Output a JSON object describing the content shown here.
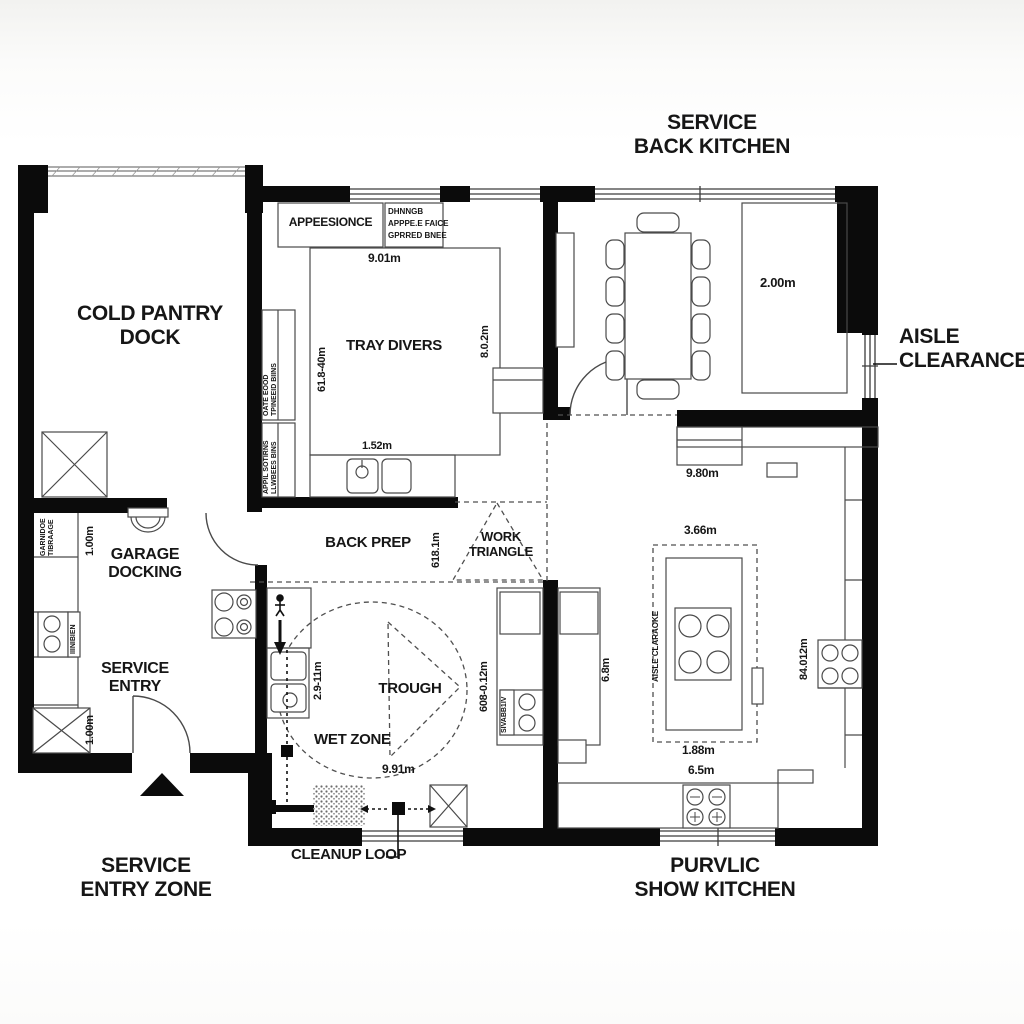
{
  "titles": {
    "back_kitchen_1": "SERVICE",
    "back_kitchen_2": "BACK KITCHEN",
    "show_kitchen_1": "PURVLIC",
    "show_kitchen_2": "SHOW KITCHEN",
    "entry_zone_1": "SERVICE",
    "entry_zone_2": "ENTRY ZONE",
    "aisle_1": "AISLE",
    "aisle_2": "CLEARANCE",
    "cleanup_loop": "CLEANUP LOOP"
  },
  "rooms": {
    "cold_pantry_1": "COLD PANTRY",
    "cold_pantry_2": "DOCK",
    "garage_1": "GARAGE",
    "garage_2": "DOCKING",
    "service_1": "SERVICE",
    "service_2": "ENTRY",
    "tray_divers": "TRAY DIVERS",
    "back_prep": "BACK PREP",
    "work_tri_1": "WORK",
    "work_tri_2": "TRIANGLE",
    "trough": "TROUGH",
    "wet_zone": "WET ZONE"
  },
  "dimensions": {
    "tray_width": "9.01m",
    "tray_left": "61.8-40m",
    "tray_right": "8.0.2m",
    "sink_run": "1.52m",
    "pass_rect": "2.00m",
    "counter_run": "9.80m",
    "island_top": "3.66m",
    "island_bottom": "1.88m",
    "island_run": "6.5m",
    "prep_depth": "618.1m",
    "wet_left": "2.9-11m",
    "wet_width": "9.91m",
    "mid_counter": "608-0.12m",
    "show_counter": "6.8m",
    "right_wall": "84.012m",
    "garage_top": "1.00m",
    "garage_bottom": "1.00m",
    "island_aisle": "AISLE CLARAOKE"
  },
  "notes": {
    "appliance_box": "APPEESIONCE",
    "appliance_col_1": "DHNNGB",
    "appliance_col_2": "APPPE.E FAICE",
    "appliance_col_3": "GPRRED BNEE",
    "strip_a1": "OATE EOOD",
    "strip_a2": "TPINEEID BIINS",
    "strip_b1": "APPIL SOTIRNS",
    "strip_b2": "LLWBEES BINS",
    "garage_strip_1": "GARNIDOE",
    "garage_strip_2": "TIBRAAGE",
    "stove_strip": "IIINIBIEN",
    "burner_strip": "SIVABB1IV"
  }
}
